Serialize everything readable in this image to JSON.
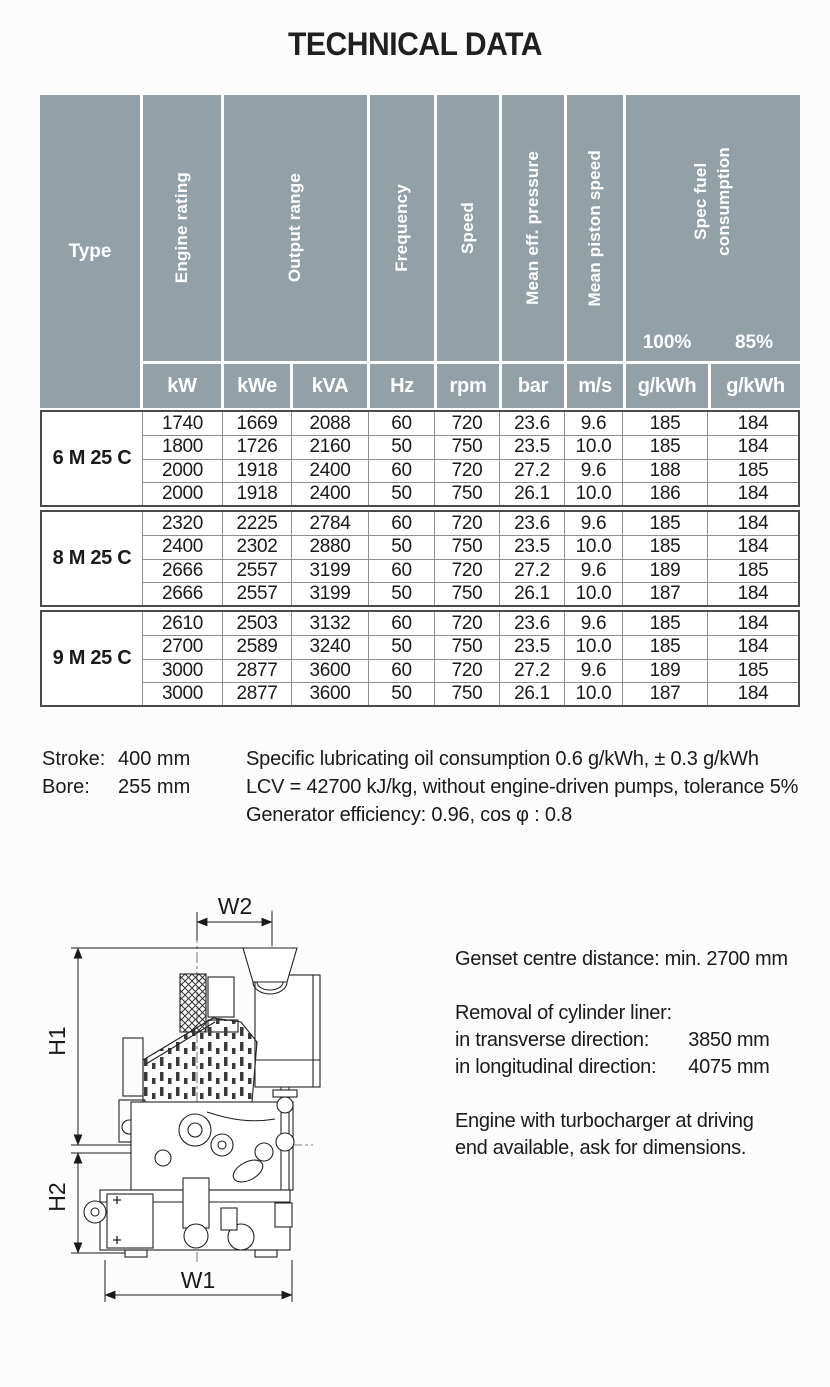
{
  "title": "TECHNICAL DATA",
  "colors": {
    "header_bg": "#93a0a8",
    "header_text": "#ffffff",
    "grid_line": "#8f8f8f",
    "group_border": "#4a4a4a",
    "text": "#1a1a1a"
  },
  "table": {
    "header": {
      "type_label": "Type",
      "engine_rating": "Engine rating",
      "output_range": "Output range",
      "frequency": "Frequency",
      "speed": "Speed",
      "mean_eff_pressure": "Mean eff. pressure",
      "mean_piston_speed": "Mean piston speed",
      "spec_fuel_line1": "Spec fuel",
      "spec_fuel_line2": "consumption",
      "load_100": "100%",
      "load_85": "85%",
      "units": [
        "kW",
        "kWe",
        "kVA",
        "Hz",
        "rpm",
        "bar",
        "m/s",
        "g/kWh",
        "g/kWh"
      ]
    },
    "groups": [
      {
        "type": "6 M 25 C",
        "rows": [
          [
            "1740",
            "1669",
            "2088",
            "60",
            "720",
            "23.6",
            "9.6",
            "185",
            "184"
          ],
          [
            "1800",
            "1726",
            "2160",
            "50",
            "750",
            "23.5",
            "10.0",
            "185",
            "184"
          ],
          [
            "2000",
            "1918",
            "2400",
            "60",
            "720",
            "27.2",
            "9.6",
            "188",
            "185"
          ],
          [
            "2000",
            "1918",
            "2400",
            "50",
            "750",
            "26.1",
            "10.0",
            "186",
            "184"
          ]
        ]
      },
      {
        "type": "8 M 25 C",
        "rows": [
          [
            "2320",
            "2225",
            "2784",
            "60",
            "720",
            "23.6",
            "9.6",
            "185",
            "184"
          ],
          [
            "2400",
            "2302",
            "2880",
            "50",
            "750",
            "23.5",
            "10.0",
            "185",
            "184"
          ],
          [
            "2666",
            "2557",
            "3199",
            "60",
            "720",
            "27.2",
            "9.6",
            "189",
            "185"
          ],
          [
            "2666",
            "2557",
            "3199",
            "50",
            "750",
            "26.1",
            "10.0",
            "187",
            "184"
          ]
        ]
      },
      {
        "type": "9 M 25 C",
        "rows": [
          [
            "2610",
            "2503",
            "3132",
            "60",
            "720",
            "23.6",
            "9.6",
            "185",
            "184"
          ],
          [
            "2700",
            "2589",
            "3240",
            "50",
            "750",
            "23.5",
            "10.0",
            "185",
            "184"
          ],
          [
            "3000",
            "2877",
            "3600",
            "60",
            "720",
            "27.2",
            "9.6",
            "189",
            "185"
          ],
          [
            "3000",
            "2877",
            "3600",
            "50",
            "750",
            "26.1",
            "10.0",
            "187",
            "184"
          ]
        ]
      }
    ]
  },
  "notes": {
    "stroke_label": "Stroke:",
    "stroke_value": "400 mm",
    "bore_label": "Bore:",
    "bore_value": "255 mm",
    "lines": [
      "Specific lubricating oil consumption 0.6 g/kWh, ± 0.3 g/kWh",
      "LCV = 42700 kJ/kg, without engine-driven pumps, tolerance 5%",
      "Generator efficiency: 0.96, cos φ : 0.8"
    ]
  },
  "drawing": {
    "w1": "W1",
    "w2": "W2",
    "h1": "H1",
    "h2": "H2"
  },
  "info": {
    "genset": "Genset centre distance: min. 2700 mm",
    "removal_title": "Removal of cylinder liner:",
    "removal_rows": [
      {
        "label": "in transverse direction:",
        "value": "3850 mm"
      },
      {
        "label": "in longitudinal direction:",
        "value": "4075 mm"
      }
    ],
    "note_line1": "Engine with turbocharger at driving",
    "note_line2": "end available, ask for dimensions."
  }
}
